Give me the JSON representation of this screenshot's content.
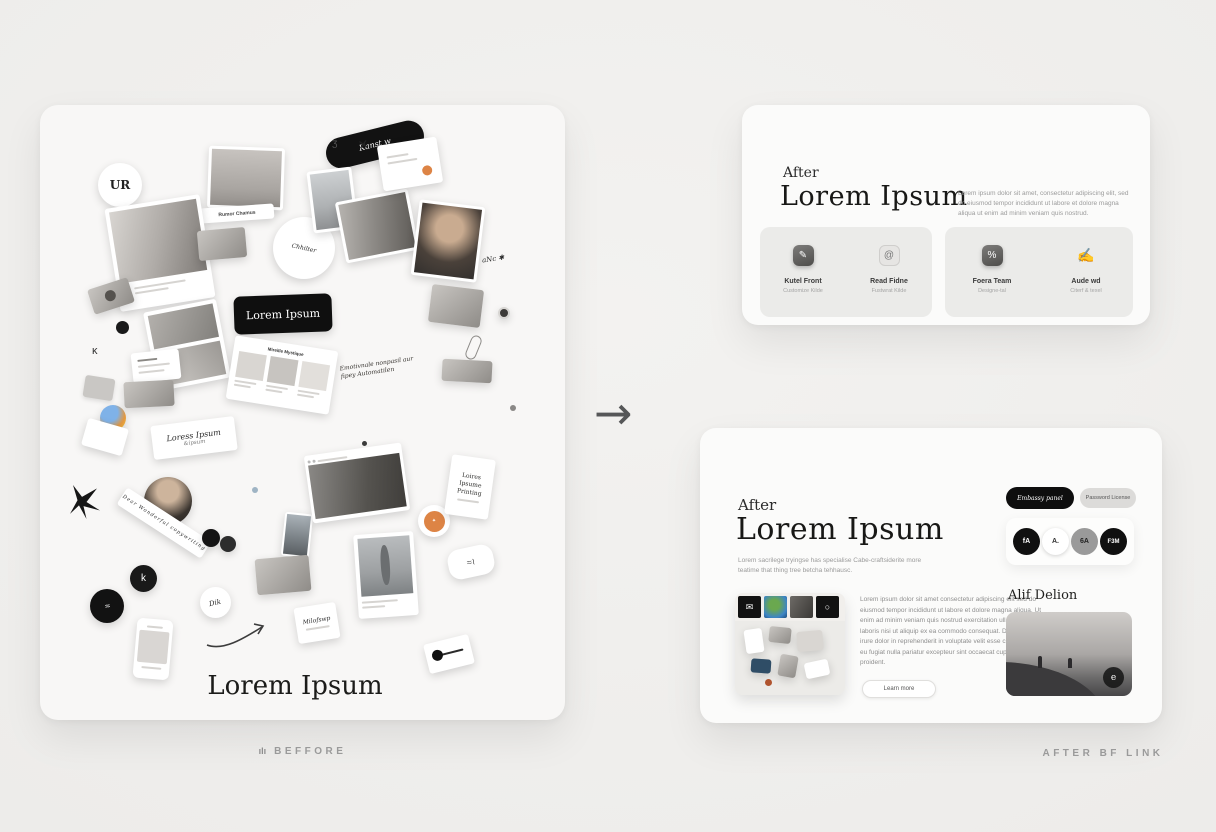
{
  "arrow_glyph": "→",
  "before": {
    "caption": "BEFFORE",
    "caption_icon": "ılı",
    "board_title": "Lorem Ipsum",
    "pill_lorem": "Lorem Ipsum",
    "pill_top": "Kanst w",
    "badge_ur": "UR",
    "tag_label": "Rumor Chamus",
    "circle_script": "Chhilter",
    "scribble_x": "✕",
    "scribble_three": "ʒ",
    "scribble_k": "κ",
    "sticker_anc": "aNc ✱",
    "note_line1": "Loress Ipsum",
    "note_line2": "&ipsum",
    "handnote": "Emotivnale nonpasil aur fipey Automatilen",
    "strip_text": "Dear Wonderful copywriting",
    "web_card_title": "Mireille Mystique",
    "badge_k": "k",
    "badge_squiggle": "≈",
    "badge_dik": "Dik",
    "print_card": "Loires\nIpsume\nPrinting",
    "pebble_squiggle": "≈≀",
    "biz_sign": "Milofswp"
  },
  "after_top": {
    "kicker": "After",
    "title": "Lorem Ipsum",
    "paragraph": "Lorem ipsum dolor sit amet, consectetur adipiscing elit, sed do eiusmod tempor incididunt ut labore et dolore magna aliqua ut enim ad minim veniam quis nostrud.",
    "features": [
      {
        "icon": "✎",
        "title": "Kutel Front",
        "subtitle": "Customize Kilde"
      },
      {
        "icon": "@",
        "title": "Read Fidne",
        "subtitle": "Fustwrat Kilde"
      },
      {
        "icon": "%",
        "title": "Foera Team",
        "subtitle": "Designe-tal"
      },
      {
        "icon": "✍",
        "title": "Aude wd",
        "subtitle": "Citerf & texel"
      }
    ]
  },
  "after_bottom": {
    "caption": "AFTER BF LINK",
    "kicker": "After",
    "title": "Lorem Ipsum",
    "subtitle": "Lorem sacrilege tryingse has specialise Cabe-craftsiderite more teatime that thing tree betcha tehhausc.",
    "body": "Lorem ipsum dolor sit amet consectetur adipiscing elit sed do eiusmod tempor incididunt ut labore et dolore magna aliqua. Ut enim ad minim veniam quis nostrud exercitation ullamco laboris nisi ut aliquip ex ea commodo consequat. Duis aute irure dolor in reprehenderit in voluptate velit esse cillum dolore eu fugiat nulla pariatur excepteur sint occaecat cupidatat non proident.",
    "learn_more": "Learn more",
    "pill_dark": "Embassy panel",
    "pill_light": "Password License",
    "social": [
      "fA",
      "A.",
      "6A",
      "F3M"
    ],
    "gallery_title": "Alif Delion",
    "photo_badge": "e",
    "mood_icon_first": "✉",
    "mood_icon_fourth": "○"
  },
  "colors": {
    "accent_orange": "#dd8445",
    "ink_black": "#111111"
  }
}
